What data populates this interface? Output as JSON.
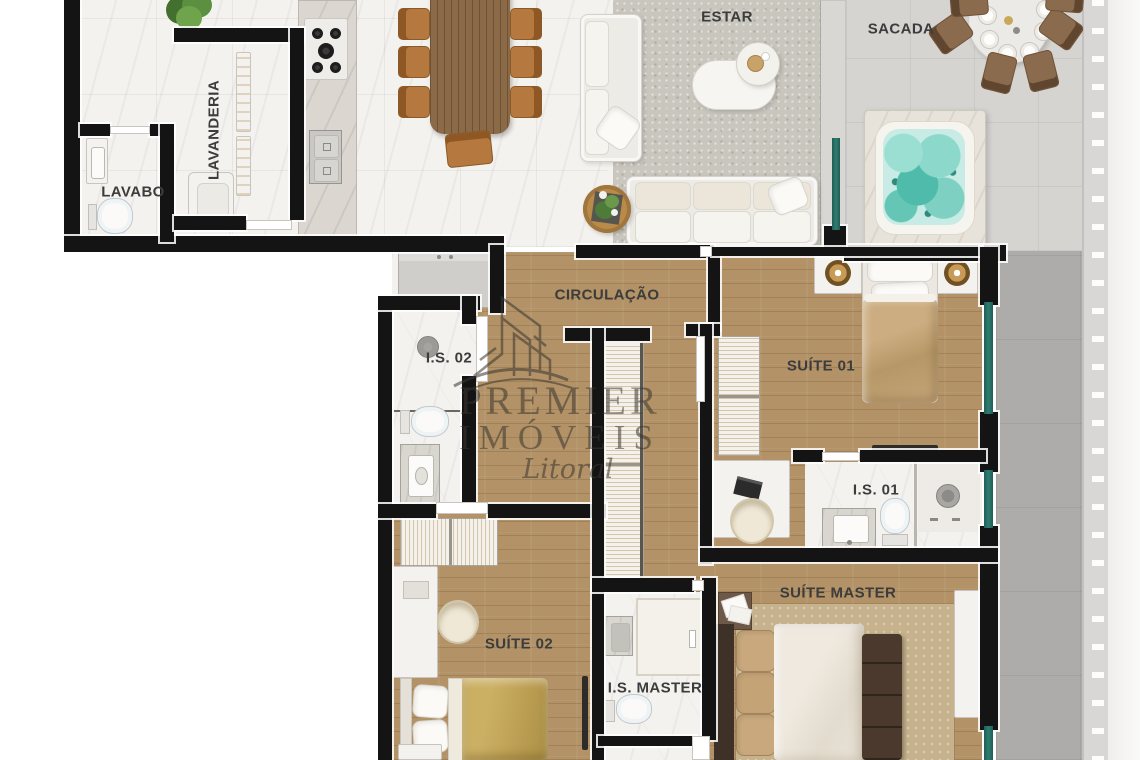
{
  "plan_title": "Apartment floor plan",
  "rooms": {
    "estar": {
      "label": "ESTAR"
    },
    "sacada": {
      "label": "SACADA"
    },
    "lavabo": {
      "label": "LAVABO"
    },
    "lavanderia": {
      "label": "LAVANDERIA"
    },
    "circulacao": {
      "label": "CIRCULAÇÃO"
    },
    "is02": {
      "label": "I.S. 02"
    },
    "suite01": {
      "label": "SUÍTE 01"
    },
    "is01": {
      "label": "I.S. 01"
    },
    "suite02": {
      "label": "SUÍTE 02"
    },
    "isMaster": {
      "label": "I.S. MASTER"
    },
    "suiteMaster": {
      "label": "SUÍTE MASTER"
    }
  },
  "watermark": {
    "line1": "PREMIER",
    "line2": "IMÓVEIS",
    "line3": "Litoral"
  },
  "colors": {
    "wall": "#141414",
    "wood": "#b29266",
    "marble": "#f3f2ef",
    "counter": "#dbd7d0",
    "rug": "#c9c6be",
    "balcony": "#d5d4d1",
    "concrete": "#aeacaa",
    "water": "#7fd0c2",
    "glass": "#2f7d72",
    "leather": "#b5793f",
    "tableWood": "#8a6a47",
    "sofa": "#edebe6",
    "blanketGold": "#bfa255",
    "blanketTan": "#c3a478",
    "bench": "#4a392c",
    "label": "#3c3c3c",
    "watermark": "#3b3630"
  }
}
